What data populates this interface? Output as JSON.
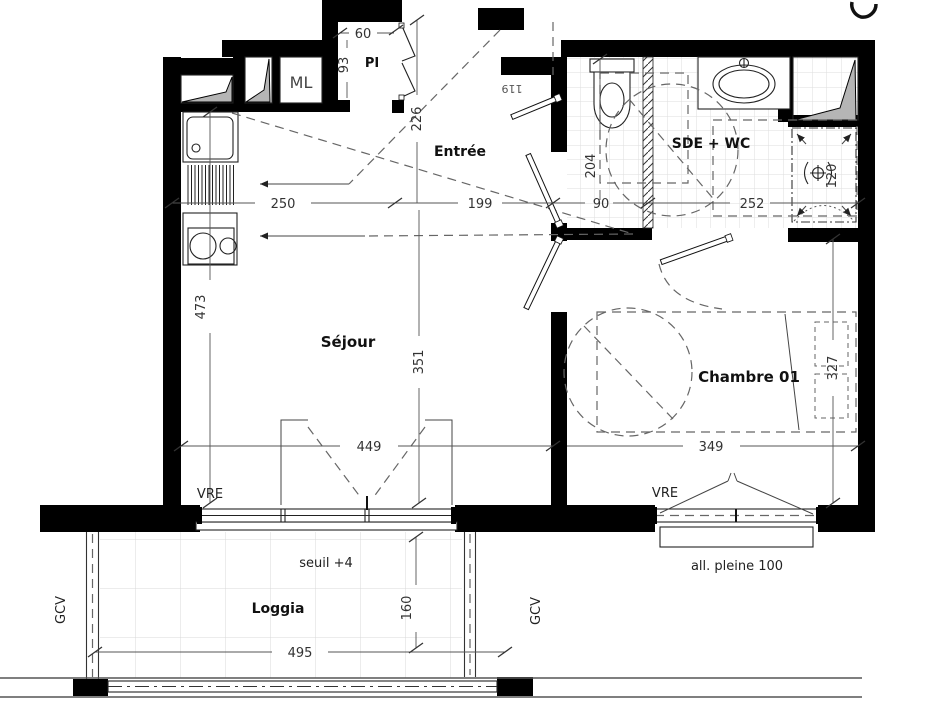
{
  "rooms": {
    "sejour": "Séjour",
    "entree": "Entrée",
    "sde_wc": "SDE + WC",
    "chambre": "Chambre 01",
    "loggia": "Loggia",
    "placard": "PI",
    "washing_machine": "ML"
  },
  "dims": {
    "kitchen_w": "250",
    "entree_w": "199",
    "wc_w": "90",
    "sde_w": "252",
    "kitchen_h": "473",
    "entree_h": "226",
    "sejour_h": "351",
    "wc_h": "204",
    "chambre_w": "349",
    "chambre_h": "327",
    "sejour_win_w": "449",
    "loggia_w": "495",
    "loggia_h": "160",
    "pi_w": "60",
    "pi_h": "93",
    "shower_w": "120",
    "door_w": "119"
  },
  "annot": {
    "vre": "VRE",
    "gcv": "GCV",
    "seuil": "seuil +4",
    "allege": "all. pleine 100"
  },
  "colors": {
    "wall": "#000000",
    "duct_fill": "#b5b5b5",
    "dash_line": "#666666",
    "tile_line": "#dedede"
  }
}
